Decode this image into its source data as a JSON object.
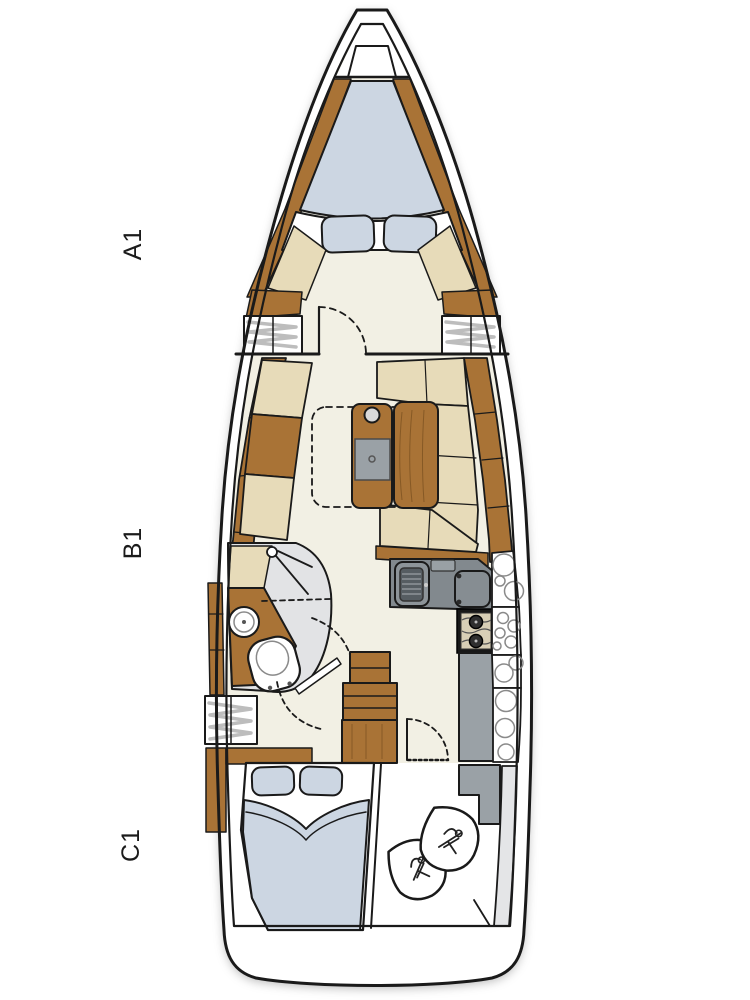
{
  "diagram": {
    "type": "yacht-deck-floorplan",
    "labels": {
      "a1": "A1",
      "b1": "B1",
      "c1": "C1"
    }
  },
  "colors": {
    "line": "#1a1a1a",
    "floor": "#f2f0e4",
    "wood": "#a97336",
    "cushion": "#e7dbb9",
    "mattress": "#ccd6e2",
    "head-floor": "#e2e3e5",
    "counter-dark": "#82898e",
    "counter-mid": "#9aa1a6",
    "stove-bed": "#d8cfb6",
    "zigzag": "#bdbdbd",
    "deck-band": "#e4e5e7"
  }
}
